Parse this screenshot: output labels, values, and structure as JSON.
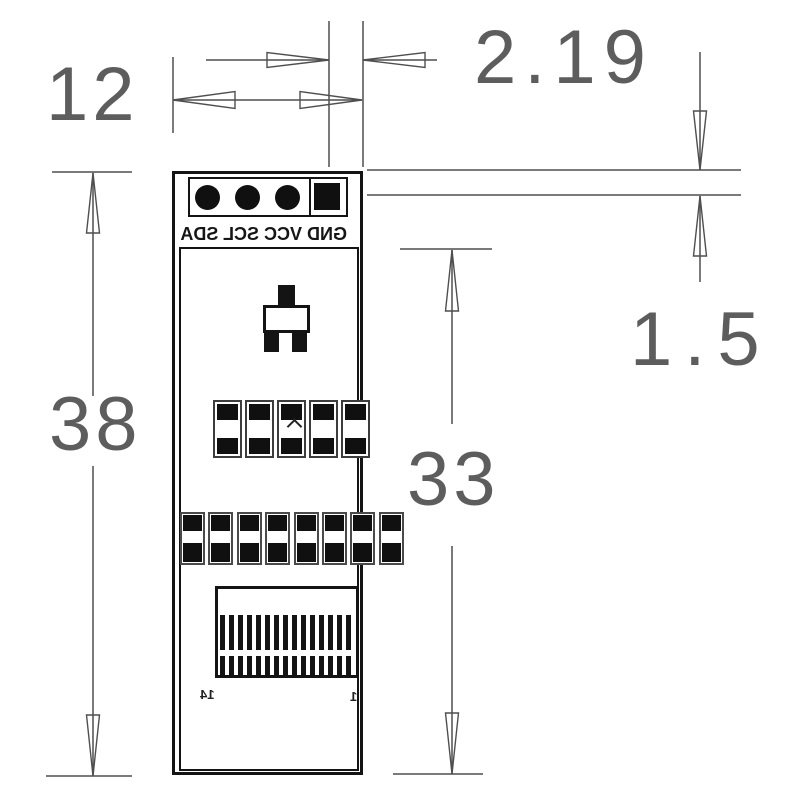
{
  "dimensions": {
    "board_width": {
      "label": "12"
    },
    "pad_edge_offset": {
      "label": "2.19"
    },
    "board_height": {
      "label": "38"
    },
    "display_height": {
      "label": "33"
    },
    "pin_row_offset": {
      "label": "1.5"
    }
  },
  "silkscreen": {
    "pin_labels": "GND VCC SCL SDA",
    "connector_pin_left": "14",
    "connector_pin_right": "1"
  },
  "board": {
    "pin_hole_count": 3,
    "square_pad_count": 1,
    "ic_pad_columns": 5,
    "bottom_pad_count": 8,
    "connector_finger_count": 15
  }
}
